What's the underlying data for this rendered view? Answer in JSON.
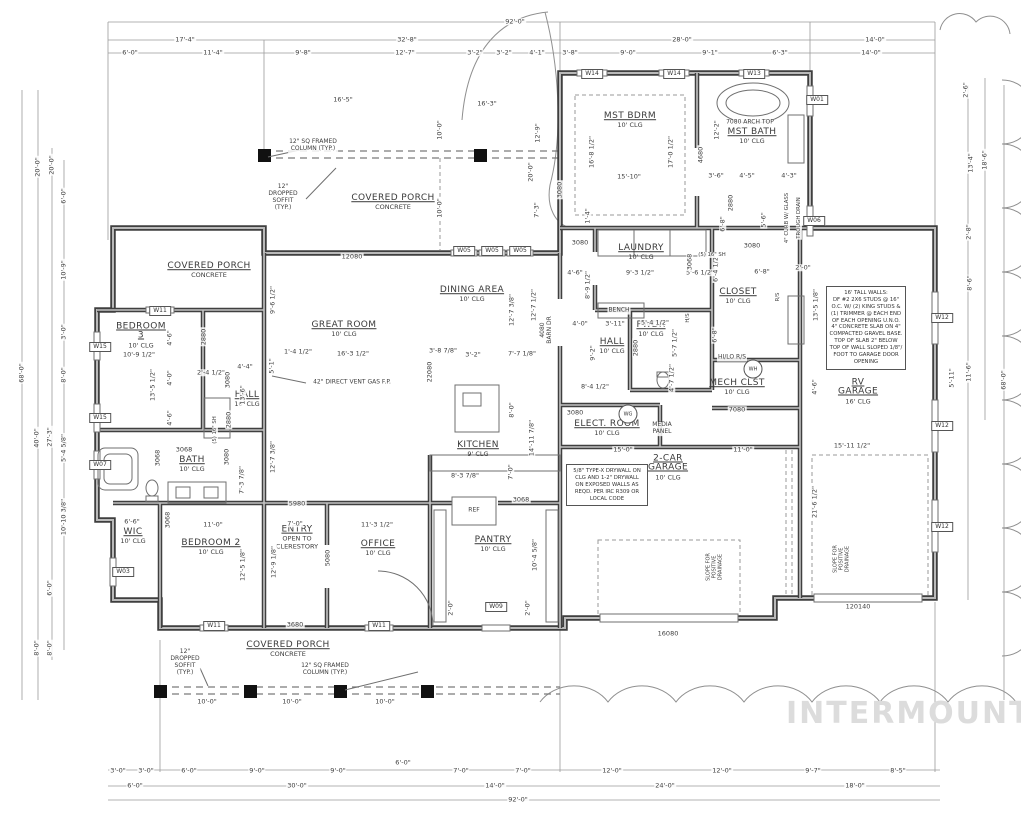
{
  "watermark": "INTERMOUNTAIN",
  "colors": {
    "wall": "#3f3f3f",
    "dim_line": "#9b9b9b",
    "text": "#3d3d3d",
    "watermark": "#dcdcdc"
  },
  "rooms": [
    {
      "n": "MST BDRM",
      "sub": "10' CLG",
      "x": 630,
      "y": 121
    },
    {
      "n": "MST BATH",
      "sub": "10' CLG",
      "x": 752,
      "y": 137
    },
    {
      "n": "LAUNDRY",
      "sub": "10' CLG",
      "x": 641,
      "y": 253
    },
    {
      "n": "CLOSET",
      "sub": "10' CLG",
      "x": 738,
      "y": 297
    },
    {
      "n": "PWDR",
      "sub": "10' CLG",
      "x": 651,
      "y": 330
    },
    {
      "n": "HALL",
      "sub": "10' CLG",
      "x": 612,
      "y": 347
    },
    {
      "n": "MECH CLST",
      "sub": "10' CLG",
      "x": 737,
      "y": 388
    },
    {
      "n": "ELECT. ROOM",
      "sub": "10' CLG",
      "x": 607,
      "y": 429
    },
    {
      "n": "2-CAR\nGARAGE",
      "sub": "10' CLG",
      "x": 668,
      "y": 468
    },
    {
      "n": "RV\nGARAGE",
      "sub": "16' CLG",
      "x": 858,
      "y": 392
    },
    {
      "n": "DINING AREA",
      "sub": "10' CLG",
      "x": 472,
      "y": 295
    },
    {
      "n": "GREAT ROOM",
      "sub": "10' CLG",
      "x": 344,
      "y": 330
    },
    {
      "n": "BEDROOM\n3",
      "sub": "10' CLG",
      "x": 141,
      "y": 336
    },
    {
      "n": "HALL",
      "sub": "10' CLG",
      "x": 247,
      "y": 400
    },
    {
      "n": "BATH",
      "sub": "10' CLG",
      "x": 192,
      "y": 465
    },
    {
      "n": "WIC",
      "sub": "10' CLG",
      "x": 133,
      "y": 537
    },
    {
      "n": "BEDROOM 2",
      "sub": "10' CLG",
      "x": 211,
      "y": 548
    },
    {
      "n": "ENTRY",
      "sub": "OPEN TO\nCLERESTORY",
      "x": 297,
      "y": 538
    },
    {
      "n": "OFFICE",
      "sub": "10' CLG",
      "x": 378,
      "y": 549
    },
    {
      "n": "KITCHEN",
      "sub": "9' CLG",
      "x": 478,
      "y": 450
    },
    {
      "n": "PANTRY",
      "sub": "10' CLG",
      "x": 493,
      "y": 545
    },
    {
      "n": "COVERED PORCH",
      "sub": "CONCRETE",
      "x": 393,
      "y": 203
    },
    {
      "n": "COVERED PORCH",
      "sub": "CONCRETE",
      "x": 209,
      "y": 271
    },
    {
      "n": "COVERED PORCH",
      "sub": "CONCRETE",
      "x": 288,
      "y": 650
    }
  ],
  "annotations": [
    {
      "t": "92'-0\"",
      "x": 515,
      "y": 22
    },
    {
      "t": "17'-4\"",
      "x": 185,
      "y": 40
    },
    {
      "t": "32'-8\"",
      "x": 407,
      "y": 40
    },
    {
      "t": "28'-0\"",
      "x": 682,
      "y": 40
    },
    {
      "t": "14'-0\"",
      "x": 875,
      "y": 40
    },
    {
      "t": "6'-0\"",
      "x": 130,
      "y": 53
    },
    {
      "t": "11'-4\"",
      "x": 213,
      "y": 53
    },
    {
      "t": "9'-8\"",
      "x": 303,
      "y": 53
    },
    {
      "t": "12'-7\"",
      "x": 405,
      "y": 53
    },
    {
      "t": "3'-2\"",
      "x": 475,
      "y": 53
    },
    {
      "t": "3'-2\"",
      "x": 504,
      "y": 53
    },
    {
      "t": "4'-1\"",
      "x": 537,
      "y": 53
    },
    {
      "t": "3'-8\"",
      "x": 570,
      "y": 53
    },
    {
      "t": "9'-0\"",
      "x": 628,
      "y": 53
    },
    {
      "t": "9'-1\"",
      "x": 710,
      "y": 53
    },
    {
      "t": "6'-3\"",
      "x": 780,
      "y": 53
    },
    {
      "t": "14'-0\"",
      "x": 871,
      "y": 53
    },
    {
      "t": "3'-0\"",
      "x": 118,
      "y": 771
    },
    {
      "t": "3'-0\"",
      "x": 146,
      "y": 771
    },
    {
      "t": "6'-0\"",
      "x": 189,
      "y": 771
    },
    {
      "t": "9'-0\"",
      "x": 257,
      "y": 771
    },
    {
      "t": "9'-0\"",
      "x": 338,
      "y": 771
    },
    {
      "t": "6'-0\"",
      "x": 403,
      "y": 763
    },
    {
      "t": "7'-0\"",
      "x": 461,
      "y": 771
    },
    {
      "t": "7'-0\"",
      "x": 523,
      "y": 771
    },
    {
      "t": "12'-0\"",
      "x": 612,
      "y": 771
    },
    {
      "t": "12'-0\"",
      "x": 722,
      "y": 771
    },
    {
      "t": "9'-7\"",
      "x": 813,
      "y": 771
    },
    {
      "t": "8'-5\"",
      "x": 898,
      "y": 771
    },
    {
      "t": "6'-0\"",
      "x": 135,
      "y": 786
    },
    {
      "t": "30'-0\"",
      "x": 297,
      "y": 786
    },
    {
      "t": "14'-0\"",
      "x": 495,
      "y": 786
    },
    {
      "t": "24'-0\"",
      "x": 665,
      "y": 786
    },
    {
      "t": "18'-0\"",
      "x": 855,
      "y": 786
    },
    {
      "t": "92'-0\"",
      "x": 518,
      "y": 800
    },
    {
      "t": "68'-0\"",
      "x": 22,
      "y": 373,
      "v": 1
    },
    {
      "t": "20'-0\"",
      "x": 38,
      "y": 167,
      "v": 1
    },
    {
      "t": "40'-0\"",
      "x": 37,
      "y": 438,
      "v": 1
    },
    {
      "t": "8'-0\"",
      "x": 37,
      "y": 648,
      "v": 1
    },
    {
      "t": "20'-0\"",
      "x": 52,
      "y": 165,
      "v": 1
    },
    {
      "t": "6'-0\"",
      "x": 64,
      "y": 196,
      "v": 1
    },
    {
      "t": "10'-9\"",
      "x": 64,
      "y": 270,
      "v": 1
    },
    {
      "t": "3'-0\"",
      "x": 64,
      "y": 332,
      "v": 1
    },
    {
      "t": "8'-0\"",
      "x": 64,
      "y": 375,
      "v": 1
    },
    {
      "t": "27'-3\"",
      "x": 50,
      "y": 437,
      "v": 1
    },
    {
      "t": "5'-4 5/8\"",
      "x": 64,
      "y": 448,
      "v": 1
    },
    {
      "t": "10'-10 3/8\"",
      "x": 64,
      "y": 517,
      "v": 1
    },
    {
      "t": "6'-0\"",
      "x": 50,
      "y": 588,
      "v": 1
    },
    {
      "t": "8'-0\"",
      "x": 50,
      "y": 648,
      "v": 1
    },
    {
      "t": "2'-6\"",
      "x": 966,
      "y": 90,
      "v": 1
    },
    {
      "t": "13'-4\"",
      "x": 971,
      "y": 163,
      "v": 1
    },
    {
      "t": "18'-6\"",
      "x": 985,
      "y": 160,
      "v": 1
    },
    {
      "t": "2'-8\"",
      "x": 969,
      "y": 232,
      "v": 1
    },
    {
      "t": "8'-6\"",
      "x": 970,
      "y": 283,
      "v": 1
    },
    {
      "t": "11'-6\"",
      "x": 969,
      "y": 372,
      "v": 1
    },
    {
      "t": "68'-0\"",
      "x": 1004,
      "y": 380,
      "v": 1
    },
    {
      "t": "5'-11\"",
      "x": 952,
      "y": 378,
      "v": 1
    },
    {
      "t": "16'-8 1/2\"",
      "x": 592,
      "y": 152,
      "v": 1
    },
    {
      "t": "17'-0 1/2\"",
      "x": 671,
      "y": 152,
      "v": 1
    },
    {
      "t": "15'-10\"",
      "x": 629,
      "y": 177
    },
    {
      "t": "12'-2\"",
      "x": 717,
      "y": 130,
      "v": 1
    },
    {
      "t": "4680",
      "x": 701,
      "y": 155,
      "v": 1
    },
    {
      "t": "3080",
      "x": 560,
      "y": 190,
      "v": 1
    },
    {
      "t": "1'-4\"",
      "x": 588,
      "y": 216,
      "v": 1
    },
    {
      "t": "3080",
      "x": 580,
      "y": 243
    },
    {
      "t": "7080 ARCH TOP",
      "x": 750,
      "y": 123,
      "s": 6
    },
    {
      "t": "3'-6\"",
      "x": 716,
      "y": 176
    },
    {
      "t": "4'-5\"",
      "x": 747,
      "y": 176
    },
    {
      "t": "4'-3\"",
      "x": 789,
      "y": 176
    },
    {
      "t": "2880",
      "x": 731,
      "y": 203,
      "v": 1
    },
    {
      "t": "6'-8\"",
      "x": 723,
      "y": 224,
      "v": 1
    },
    {
      "t": "5'-6\"",
      "x": 764,
      "y": 220,
      "v": 1
    },
    {
      "t": "3080",
      "x": 752,
      "y": 246
    },
    {
      "t": "4\" CURB W/ GLASS",
      "x": 787,
      "y": 218,
      "v": 1,
      "s": 5.3
    },
    {
      "t": "TROUGH DRAIN",
      "x": 799,
      "y": 218,
      "v": 1,
      "s": 5.3
    },
    {
      "t": "16'-5\"",
      "x": 343,
      "y": 100
    },
    {
      "t": "16'-3\"",
      "x": 487,
      "y": 104
    },
    {
      "t": "10'-0\"",
      "x": 440,
      "y": 130,
      "v": 1
    },
    {
      "t": "10'-0\"",
      "x": 440,
      "y": 208,
      "v": 1
    },
    {
      "t": "12'-9\"",
      "x": 538,
      "y": 133,
      "v": 1
    },
    {
      "t": "20'-0\"",
      "x": 531,
      "y": 172,
      "v": 1
    },
    {
      "t": "7'-3\"",
      "x": 537,
      "y": 210,
      "v": 1
    },
    {
      "t": "12080",
      "x": 352,
      "y": 257
    },
    {
      "t": "12\" SQ FRAMED\nCOLUMN (TYP.)",
      "x": 313,
      "y": 146,
      "s": 6
    },
    {
      "t": "12\"\nDROPPED\nSOFFIT\n(TYP.)",
      "x": 283,
      "y": 198,
      "s": 6
    },
    {
      "t": "12\" SQ FRAMED\nCOLUMN (TYP.)",
      "x": 325,
      "y": 670,
      "s": 6
    },
    {
      "t": "12\"\nDROPPED\nSOFFIT\n(TYP.)",
      "x": 185,
      "y": 663,
      "s": 6
    },
    {
      "t": "10'-0\"",
      "x": 207,
      "y": 702
    },
    {
      "t": "10'-0\"",
      "x": 292,
      "y": 702
    },
    {
      "t": "10'-0\"",
      "x": 385,
      "y": 702
    },
    {
      "t": "3680",
      "x": 295,
      "y": 625
    },
    {
      "t": "1'-4 1/2\"",
      "x": 298,
      "y": 352
    },
    {
      "t": "16'-3 1/2\"",
      "x": 353,
      "y": 354
    },
    {
      "t": "3'-8 7/8\"",
      "x": 443,
      "y": 351
    },
    {
      "t": "3'-2\"",
      "x": 473,
      "y": 355
    },
    {
      "t": "7'-7 1/8\"",
      "x": 522,
      "y": 354
    },
    {
      "t": "12'-7 3/8\"",
      "x": 512,
      "y": 310,
      "v": 1
    },
    {
      "t": "12'-7 1/2\"",
      "x": 534,
      "y": 305,
      "v": 1
    },
    {
      "t": "8'-0\"",
      "x": 512,
      "y": 410,
      "v": 1
    },
    {
      "t": "4080\nBARN DR",
      "x": 547,
      "y": 330,
      "v": 1,
      "s": 6
    },
    {
      "t": "22080",
      "x": 430,
      "y": 372,
      "v": 1
    },
    {
      "t": "42\" DIRECT VENT GAS F.P.",
      "x": 352,
      "y": 383,
      "s": 6
    },
    {
      "t": "9'-6 1/2\"",
      "x": 273,
      "y": 300,
      "v": 1
    },
    {
      "t": "5'-1\"",
      "x": 272,
      "y": 366,
      "v": 1
    },
    {
      "t": "12'-7 3/8\"",
      "x": 273,
      "y": 457,
      "v": 1
    },
    {
      "t": "10'-9 1/2\"",
      "x": 139,
      "y": 355
    },
    {
      "t": "13'-5 1/2\"",
      "x": 153,
      "y": 385,
      "v": 1
    },
    {
      "t": "4'-6\"",
      "x": 170,
      "y": 338,
      "v": 1
    },
    {
      "t": "4'-0\"",
      "x": 170,
      "y": 378,
      "v": 1
    },
    {
      "t": "4'-6\"",
      "x": 170,
      "y": 418,
      "v": 1
    },
    {
      "t": "2'-4 1/2\"",
      "x": 211,
      "y": 373
    },
    {
      "t": "4'-4\"",
      "x": 245,
      "y": 367
    },
    {
      "t": "13'-6\"",
      "x": 243,
      "y": 395,
      "v": 1
    },
    {
      "t": "2880",
      "x": 204,
      "y": 337,
      "v": 1
    },
    {
      "t": "3080",
      "x": 228,
      "y": 380,
      "v": 1
    },
    {
      "t": "(5) 16\" SH",
      "x": 215,
      "y": 430,
      "v": 1,
      "s": 5.3
    },
    {
      "t": "2880",
      "x": 229,
      "y": 420,
      "v": 1
    },
    {
      "t": "3068",
      "x": 158,
      "y": 458,
      "v": 1
    },
    {
      "t": "3068",
      "x": 184,
      "y": 450
    },
    {
      "t": "3080",
      "x": 227,
      "y": 457,
      "v": 1
    },
    {
      "t": "7'-3 7/8\"",
      "x": 242,
      "y": 480,
      "v": 1
    },
    {
      "t": "6'-6\"",
      "x": 132,
      "y": 522
    },
    {
      "t": "11'-0\"",
      "x": 213,
      "y": 525
    },
    {
      "t": "3068",
      "x": 168,
      "y": 520,
      "v": 1
    },
    {
      "t": "12'-5 1/8\"",
      "x": 243,
      "y": 565,
      "v": 1
    },
    {
      "t": "12'-9 1/8\"",
      "x": 274,
      "y": 562,
      "v": 1
    },
    {
      "t": "7'-0\"",
      "x": 295,
      "y": 524
    },
    {
      "t": "11'-3 1/2\"",
      "x": 377,
      "y": 525
    },
    {
      "t": "5980",
      "x": 297,
      "y": 504
    },
    {
      "t": "5080",
      "x": 328,
      "y": 558,
      "v": 1
    },
    {
      "t": "8'-3 7/8\"",
      "x": 465,
      "y": 476
    },
    {
      "t": "7'-0\"",
      "x": 511,
      "y": 472,
      "v": 1
    },
    {
      "t": "14'-11 7/8\"",
      "x": 532,
      "y": 438,
      "v": 1
    },
    {
      "t": "3068",
      "x": 521,
      "y": 500
    },
    {
      "t": "10'-4 5/8\"",
      "x": 535,
      "y": 555,
      "v": 1
    },
    {
      "t": "2'-0\"",
      "x": 451,
      "y": 608,
      "v": 1
    },
    {
      "t": "2'-0\"",
      "x": 528,
      "y": 608,
      "v": 1
    },
    {
      "t": "REF",
      "x": 474,
      "y": 511,
      "s": 6
    },
    {
      "t": "4'-6\"",
      "x": 575,
      "y": 273
    },
    {
      "t": "9'-3 1/2\"",
      "x": 640,
      "y": 273
    },
    {
      "t": "5'-6 1/2\"",
      "x": 700,
      "y": 273
    },
    {
      "t": "8'-9 1/2\"",
      "x": 588,
      "y": 285,
      "v": 1
    },
    {
      "t": "3068",
      "x": 690,
      "y": 262,
      "v": 1
    },
    {
      "t": "6'-4 1/2\"",
      "x": 716,
      "y": 268,
      "v": 1
    },
    {
      "t": "(5) 16\" SH",
      "x": 712,
      "y": 255,
      "s": 5.3
    },
    {
      "t": "6'-8\"",
      "x": 762,
      "y": 272
    },
    {
      "t": "R/S",
      "x": 778,
      "y": 297,
      "v": 1,
      "s": 5.3
    },
    {
      "t": "BENCH",
      "x": 619,
      "y": 311,
      "s": 6
    },
    {
      "t": "4'-0\"",
      "x": 580,
      "y": 324
    },
    {
      "t": "3'-11\"",
      "x": 615,
      "y": 324
    },
    {
      "t": "5'-4 1/2\"",
      "x": 655,
      "y": 323
    },
    {
      "t": "6'-8\"",
      "x": 715,
      "y": 335,
      "v": 1
    },
    {
      "t": "9'-2\"",
      "x": 593,
      "y": 353,
      "v": 1
    },
    {
      "t": "2880",
      "x": 636,
      "y": 348,
      "v": 1
    },
    {
      "t": "5'-7 1/2\"",
      "x": 675,
      "y": 343,
      "v": 1
    },
    {
      "t": "H/S",
      "x": 688,
      "y": 318,
      "v": 1,
      "s": 5.3
    },
    {
      "t": "HI/LO R/S",
      "x": 732,
      "y": 358,
      "s": 6
    },
    {
      "t": "8'-4 1/2\"",
      "x": 595,
      "y": 387
    },
    {
      "t": "4'-7 1/2\"",
      "x": 672,
      "y": 378,
      "v": 1
    },
    {
      "t": "3080",
      "x": 575,
      "y": 413
    },
    {
      "t": "7080",
      "x": 737,
      "y": 410
    },
    {
      "t": "MEDIA\nPANEL",
      "x": 662,
      "y": 429,
      "s": 6
    },
    {
      "t": "15'-0\"",
      "x": 623,
      "y": 450
    },
    {
      "t": "11'-0\"",
      "x": 743,
      "y": 450
    },
    {
      "t": "16080",
      "x": 668,
      "y": 634
    },
    {
      "t": "120140",
      "x": 858,
      "y": 607
    },
    {
      "t": "21'-6 1/2\"",
      "x": 815,
      "y": 502,
      "v": 1
    },
    {
      "t": "SLOPE FOR\nPOSITIVE\nDRAINAGE",
      "x": 715,
      "y": 567,
      "v": 1,
      "s": 5
    },
    {
      "t": "SLOPE FOR\nPOSITIVE\nDRAINAGE",
      "x": 842,
      "y": 559,
      "v": 1,
      "s": 5
    },
    {
      "t": "2'-0\"",
      "x": 803,
      "y": 268
    },
    {
      "t": "13'-5 1/8\"",
      "x": 816,
      "y": 305,
      "v": 1
    },
    {
      "t": "4'-6\"",
      "x": 815,
      "y": 387,
      "v": 1
    },
    {
      "t": "15'-11 1/2\"",
      "x": 852,
      "y": 446
    }
  ],
  "window_tags": [
    {
      "t": "W14",
      "x": 592,
      "y": 74
    },
    {
      "t": "W14",
      "x": 674,
      "y": 74
    },
    {
      "t": "W13",
      "x": 754,
      "y": 74
    },
    {
      "t": "W01",
      "x": 817,
      "y": 100
    },
    {
      "t": "W06",
      "x": 814,
      "y": 221
    },
    {
      "t": "W05",
      "x": 464,
      "y": 251
    },
    {
      "t": "W05",
      "x": 492,
      "y": 251
    },
    {
      "t": "W05",
      "x": 520,
      "y": 251
    },
    {
      "t": "W11",
      "x": 160,
      "y": 311
    },
    {
      "t": "W11",
      "x": 214,
      "y": 626
    },
    {
      "t": "W11",
      "x": 379,
      "y": 626
    },
    {
      "t": "W09",
      "x": 496,
      "y": 607
    },
    {
      "t": "W15",
      "x": 100,
      "y": 347
    },
    {
      "t": "W15",
      "x": 100,
      "y": 418
    },
    {
      "t": "W07",
      "x": 100,
      "y": 465
    },
    {
      "t": "W03",
      "x": 123,
      "y": 572
    },
    {
      "t": "W12",
      "x": 942,
      "y": 318
    },
    {
      "t": "W12",
      "x": 942,
      "y": 426
    },
    {
      "t": "W12",
      "x": 942,
      "y": 527
    }
  ],
  "circle_tags": [
    {
      "t": "WH",
      "x": 753,
      "y": 369
    },
    {
      "t": "WG",
      "x": 628,
      "y": 414
    }
  ],
  "note_boxes": [
    {
      "x": 826,
      "y": 286,
      "w": 74,
      "text": "16' TALL WALLS:\nDF #2 2X6 STUDS @ 16\"\nO.C. W/ (2) KING STUDS &\n(1) TRIMMER @ EACH END\nOF EACH OPENING U.N.O.\n4\" CONCRETE SLAB ON 4\"\nCOMPACTED GRAVEL BASE.\nTOP OF SLAB 2\" BELOW\nTOP OF WALL SLOPED 1/8\"/\nFOOT TO GARAGE DOOR\nOPENING"
    },
    {
      "x": 566,
      "y": 464,
      "w": 76,
      "text": "5/8\" TYPE-X DRYWALL ON\nCLG AND 1-2\" DRYWALL\nON EXPOSED WALLS AS\nREQD. PER IRC R309 OR\nLOCAL CODE"
    }
  ]
}
